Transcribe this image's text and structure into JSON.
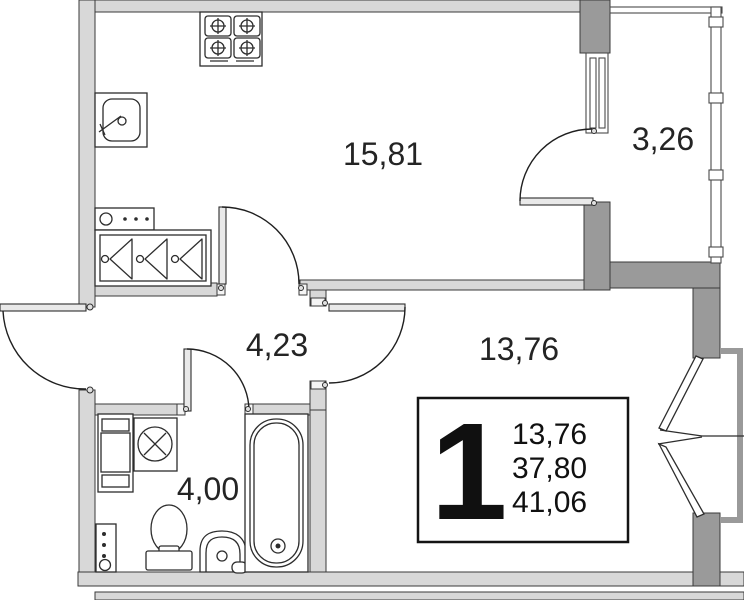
{
  "plan_type": "floor-plan",
  "rooms": {
    "kitchen_living": {
      "name": "kitchen-living-room",
      "area_m2": "15,81"
    },
    "balcony": {
      "name": "balcony",
      "area_m2": "3,26"
    },
    "hallway": {
      "name": "hallway",
      "area_m2": "4,23"
    },
    "living_room": {
      "name": "room",
      "area_m2": "13,76"
    },
    "bathroom": {
      "name": "bathroom",
      "area_m2": "4,00"
    }
  },
  "info_box": {
    "room_count": "1",
    "living_area": "13,76",
    "apartment_area": "37,80",
    "total_area": "41,06"
  },
  "fixtures": [
    "stove-icon",
    "kitchen-sink-icon",
    "shoe-shelf-icon",
    "wardrobe-icon",
    "bathroom-cabinet-icon",
    "washing-machine-icon",
    "utility-riser-icon",
    "toilet-icon",
    "bathroom-sink-icon",
    "bathtub-icon"
  ],
  "colors": {
    "background": "#ffffff",
    "wall_fill": "#d8d8d8",
    "wall_dark": "#9a9a9a",
    "outline": "#3a3a3a",
    "fixture_line": "#2d2d2d",
    "text": "#242424"
  }
}
